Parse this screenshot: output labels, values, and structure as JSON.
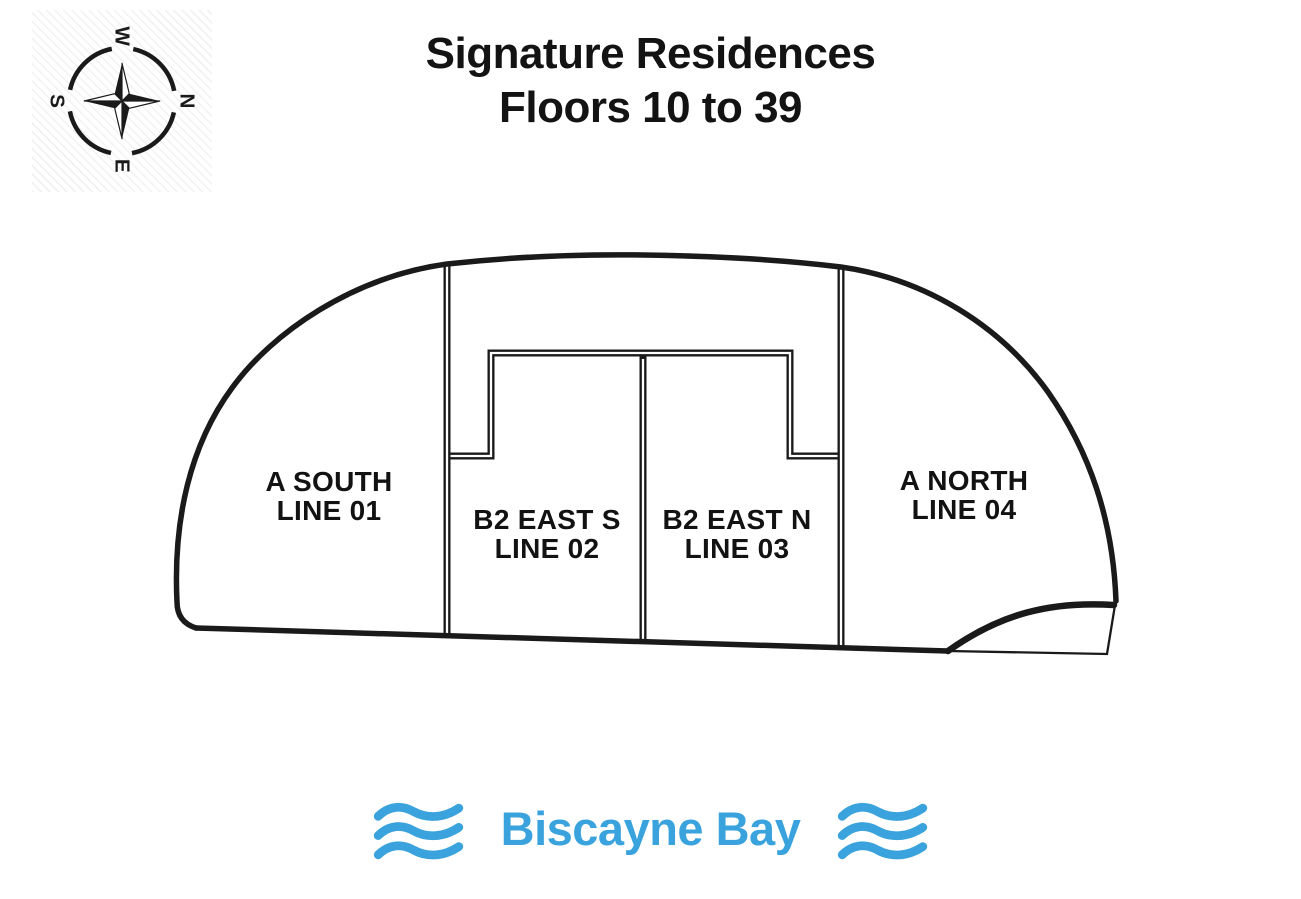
{
  "title": {
    "line1": "Signature Residences",
    "line2": "Floors 10 to 39"
  },
  "compass": {
    "north": "N",
    "east": "E",
    "south": "S",
    "west": "W",
    "rotation_deg": 90
  },
  "plan": {
    "units": [
      {
        "id": "01",
        "name": "A SOUTH",
        "line": "LINE 01"
      },
      {
        "id": "02",
        "name": "B2 EAST S",
        "line": "LINE 02"
      },
      {
        "id": "03",
        "name": "B2 EAST N",
        "line": "LINE 03"
      },
      {
        "id": "04",
        "name": "A NORTH",
        "line": "LINE 04"
      }
    ]
  },
  "bay": {
    "label": "Biscayne Bay"
  },
  "colors": {
    "outline": "#1a1a1a",
    "text": "#121212",
    "water_blue": "#3aa3dd"
  }
}
